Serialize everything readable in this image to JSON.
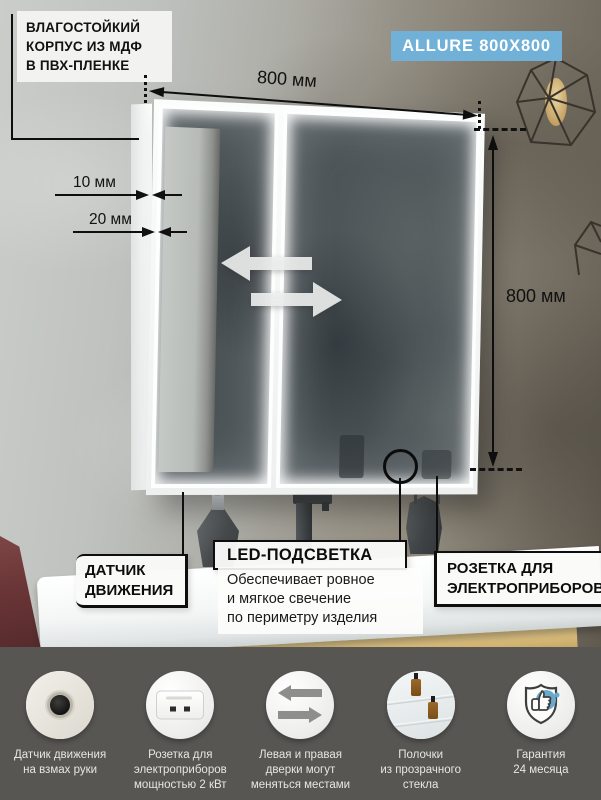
{
  "product": {
    "badge": "ALLURE 800X800"
  },
  "colors": {
    "badge_bg": "#72b1d7",
    "footer_bg": "#585653",
    "warranty_accent": "#69aacc",
    "annotation_ink": "#0e0e0e"
  },
  "dimensions": {
    "width_label": "800 мм",
    "height_label": "800 мм",
    "gap_top_label": "10 мм",
    "gap_bottom_label": "20 мм"
  },
  "callouts": {
    "body": {
      "lines": [
        "ВЛАГОСТОЙКИЙ",
        "КОРПУС ИЗ МДФ",
        "В ПВХ-ПЛЕНКЕ"
      ]
    },
    "motion_sensor": {
      "lines": [
        "ДАТЧИК",
        "ДВИЖЕНИЯ"
      ]
    },
    "led": {
      "title": "LED-ПОДСВЕТКА",
      "desc_lines": [
        "Обеспечивает ровное",
        "и мягкое свечение",
        "по периметру изделия"
      ]
    },
    "socket": {
      "lines": [
        "РОЗЕТКА ДЛЯ",
        "ЭЛЕКТРОПРИБОРОВ"
      ]
    }
  },
  "features": [
    {
      "icon": "motion-sensor-photo",
      "lines": [
        "Датчик движения",
        "на взмах руки"
      ]
    },
    {
      "icon": "power-socket-photo",
      "lines": [
        "Розетка для",
        "электроприборов",
        "мощностью 2 кВт"
      ]
    },
    {
      "icon": "swap-doors-arrows",
      "lines": [
        "Левая и правая",
        "дверки могут",
        "меняться местами"
      ]
    },
    {
      "icon": "glass-shelves-photo",
      "lines": [
        "Полочки",
        "из прозрачного",
        "стекла"
      ]
    },
    {
      "icon": "warranty-shield",
      "lines": [
        "Гарантия",
        "24 месяца"
      ]
    }
  ]
}
